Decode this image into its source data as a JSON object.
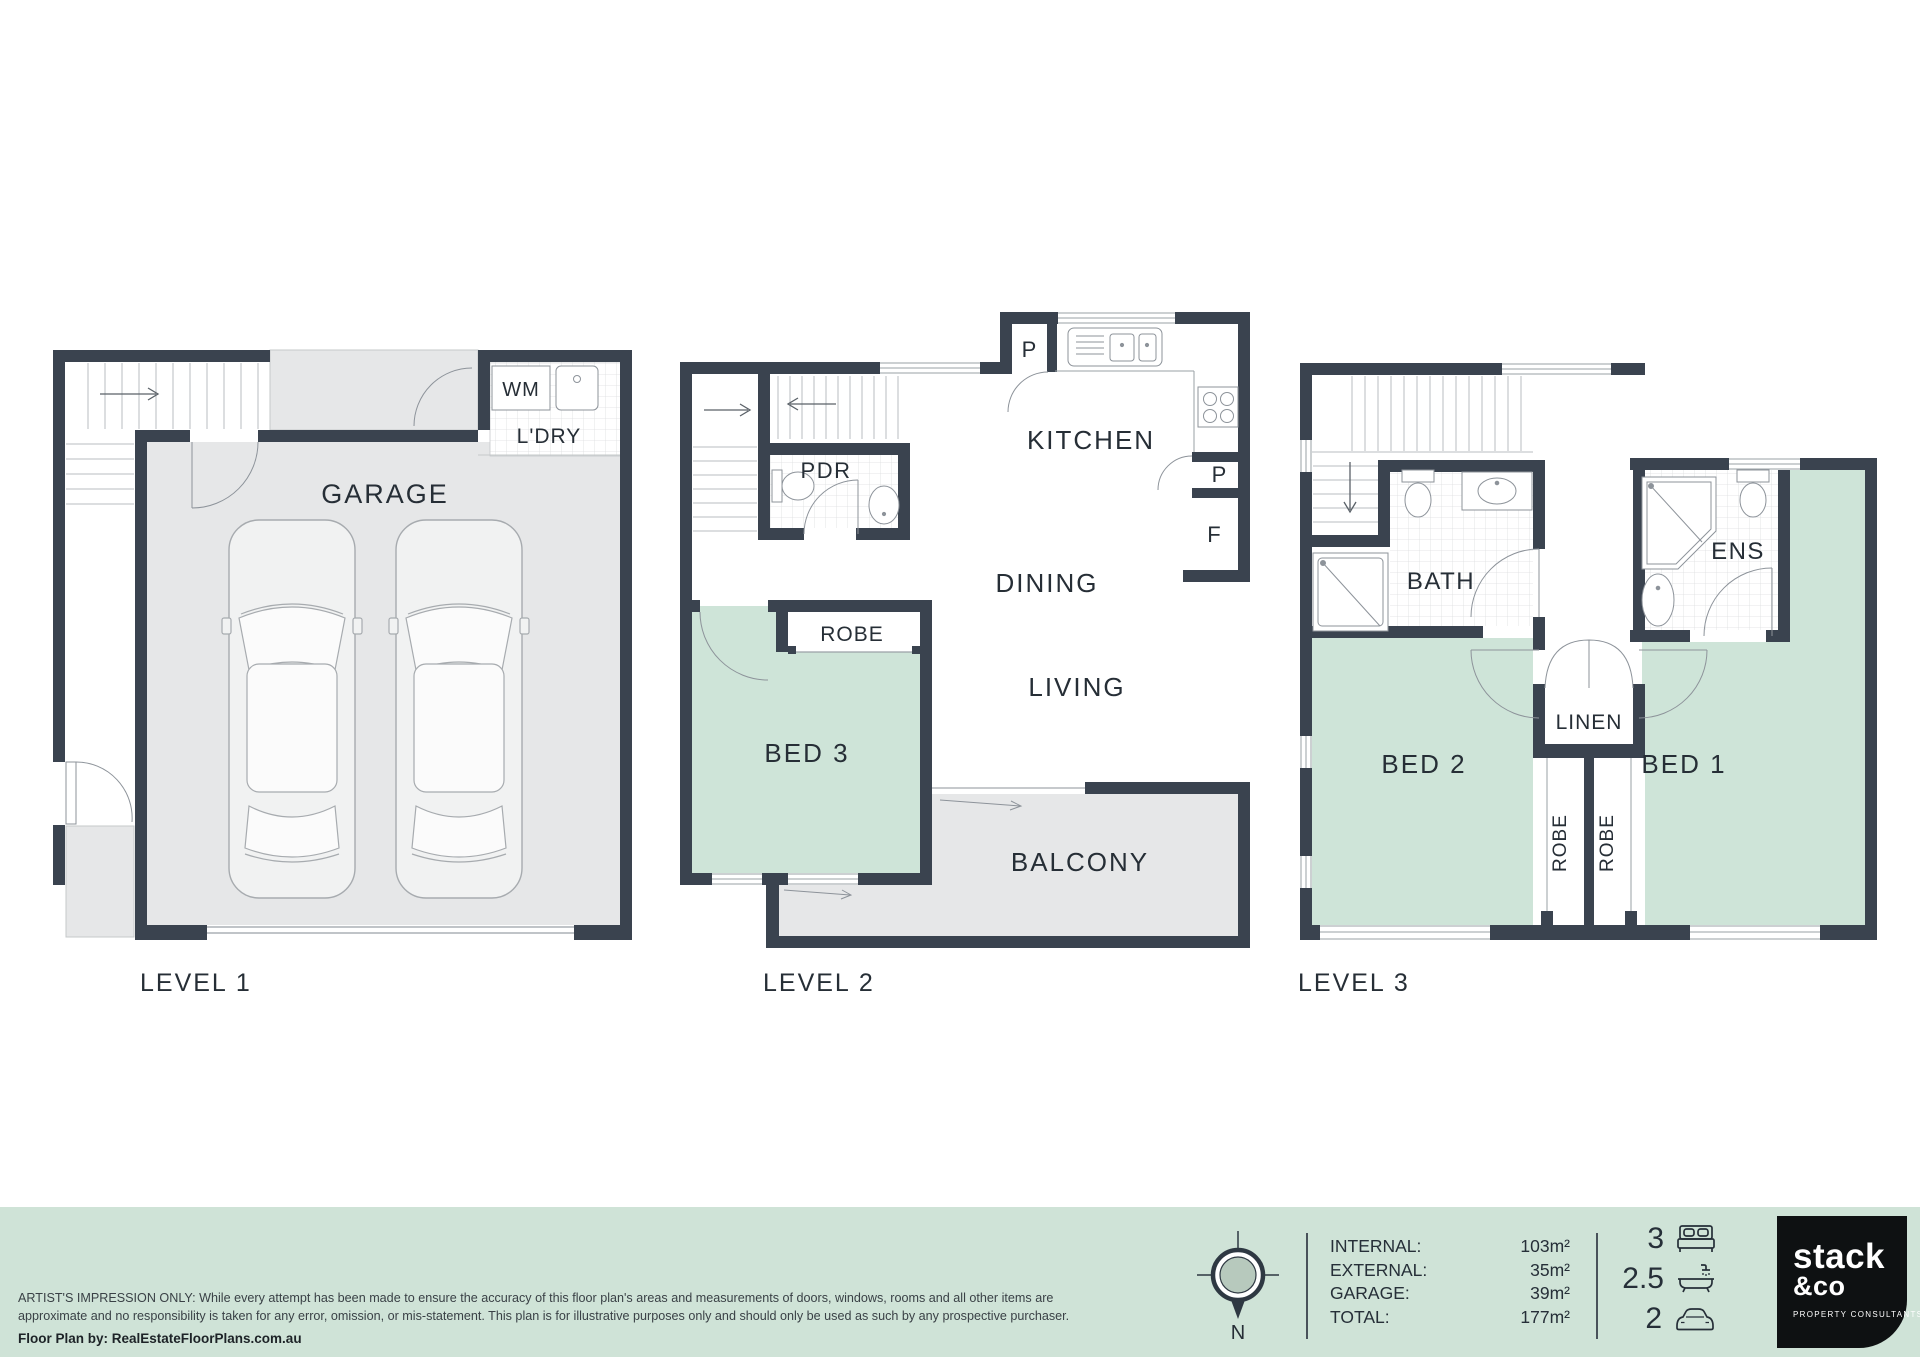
{
  "levels": {
    "l1": {
      "title": "LEVEL 1",
      "garage": "GARAGE",
      "wm": "WM",
      "ldry": "L'DRY"
    },
    "l2": {
      "title": "LEVEL 2",
      "kitchen": "KITCHEN",
      "dining": "DINING",
      "living": "LIVING",
      "bed3": "BED 3",
      "robe": "ROBE",
      "pdr": "PDR",
      "balcony": "BALCONY",
      "pantry_top": "P",
      "pantry_side": "P",
      "fridge": "F"
    },
    "l3": {
      "title": "LEVEL 3",
      "bath": "BATH",
      "ens": "ENS",
      "linen": "LINEN",
      "robe_left": "ROBE",
      "robe_right": "ROBE",
      "bed2": "BED 2",
      "bed1": "BED 1"
    }
  },
  "footer": {
    "disclaimer_line1": "ARTIST'S IMPRESSION ONLY: While every attempt has been made to ensure the accuracy of this floor plan's areas and measurements of doors, windows, rooms and all other items are",
    "disclaimer_line2": "approximate and no responsibility is taken for any error, omission, or mis-statement. This plan is for illustrative purposes only and should only be used as such by any prospective purchaser.",
    "credit": "Floor Plan by: RealEstateFloorPlans.com.au",
    "compass_north": "N",
    "areas": [
      {
        "label": "INTERNAL:",
        "value": "103m²"
      },
      {
        "label": "EXTERNAL:",
        "value": "35m²"
      },
      {
        "label": "GARAGE:",
        "value": "39m²"
      },
      {
        "label": "TOTAL:",
        "value": "177m²"
      }
    ],
    "counts": {
      "beds": "3",
      "baths": "2.5",
      "cars": "2"
    },
    "logo": {
      "word1": "stack",
      "word2": "&co",
      "tagline": "PROPERTY CONSULTANTS"
    }
  },
  "colors": {
    "wall": "#3a434f",
    "floor_gray": "#e6e7e8",
    "room_green": "#cee4d8",
    "footer_bg": "#cfe3d7",
    "logo_bg": "#0e1112",
    "line": "#9aa0a6",
    "text": "#262e36"
  }
}
